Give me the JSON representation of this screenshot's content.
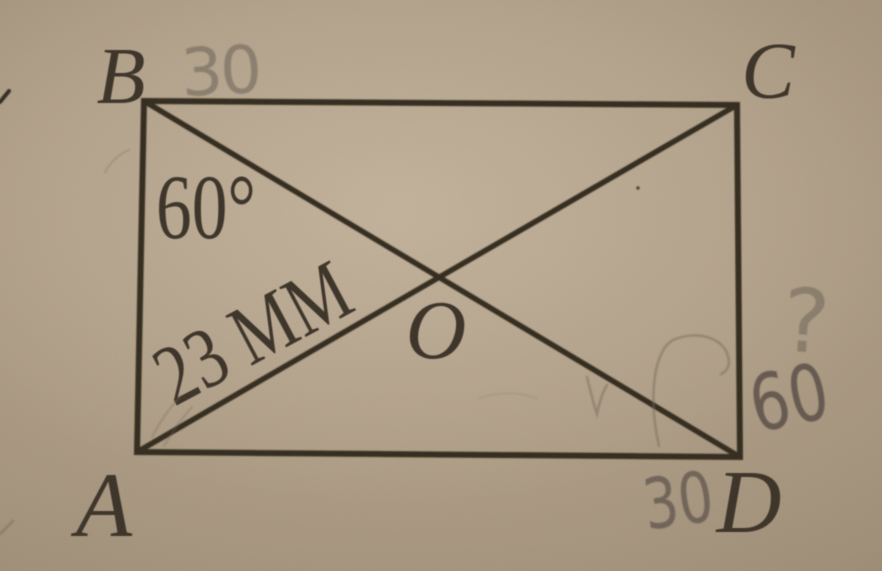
{
  "figure": {
    "type": "rectangle-with-diagonals",
    "vertices": {
      "top_left": "B",
      "top_right": "C",
      "bottom_left": "A",
      "bottom_right": "D",
      "diagonal_intersection": "O"
    },
    "labels": {
      "angle_at_b": "60°",
      "segment_ao": "23 мм"
    },
    "pencil": {
      "top_side": "30",
      "bottom_side": "30",
      "right_angle": "60",
      "unknown": "?"
    }
  },
  "colors": {
    "paper_center": "#b7a58d",
    "paper_edge": "#84735d",
    "ink": "#31291f",
    "pencil_gray": "#6f6557"
  }
}
